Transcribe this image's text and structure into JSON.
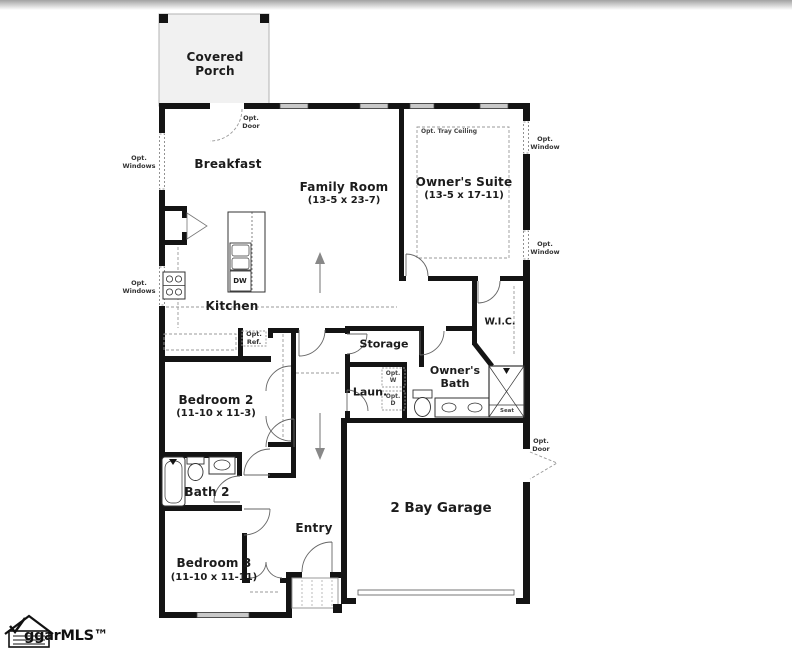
{
  "plan": {
    "rooms": {
      "covered_porch": {
        "label": "Covered Porch"
      },
      "breakfast": {
        "label": "Breakfast"
      },
      "family_room": {
        "label": "Family Room",
        "dims": "(13-5 x 23-7)"
      },
      "owners_suite": {
        "label": "Owner's Suite",
        "dims": "(13-5 x 17-11)"
      },
      "kitchen": {
        "label": "Kitchen"
      },
      "storage": {
        "label": "Storage"
      },
      "wic": {
        "label": "W.I.C."
      },
      "owners_bath": {
        "label": "Owner's Bath"
      },
      "laundry": {
        "label": "Laun."
      },
      "bedroom2": {
        "label": "Bedroom 2",
        "dims": "(11-10 x 11-3)"
      },
      "bath2": {
        "label": "Bath 2"
      },
      "bedroom3": {
        "label": "Bedroom 3",
        "dims": "(11-10 x 11-11)"
      },
      "entry": {
        "label": "Entry"
      },
      "garage": {
        "label": "2 Bay Garage"
      }
    },
    "annotations": {
      "opt_door_breakfast": "Opt. Door",
      "opt_windows_upper": "Opt. Windows",
      "opt_windows_lower": "Opt. Windows",
      "opt_window_upper": "Opt. Window",
      "opt_window_lower": "Opt. Window",
      "opt_tray_ceiling": "Opt. Tray Ceiling",
      "opt_ref": "Opt. Ref.",
      "opt_washer": "Opt. W",
      "opt_dryer": "Opt. D",
      "opt_door_garage": "Opt. Door",
      "shower_seat": "Seat",
      "dishwasher": "DW"
    },
    "watermark": {
      "text": "ggarMLS™"
    },
    "colors": {
      "wall": "#141414",
      "porch_fill": "#f1f1f1",
      "window_fill": "#c9c9c9",
      "dash": "#999999"
    }
  }
}
